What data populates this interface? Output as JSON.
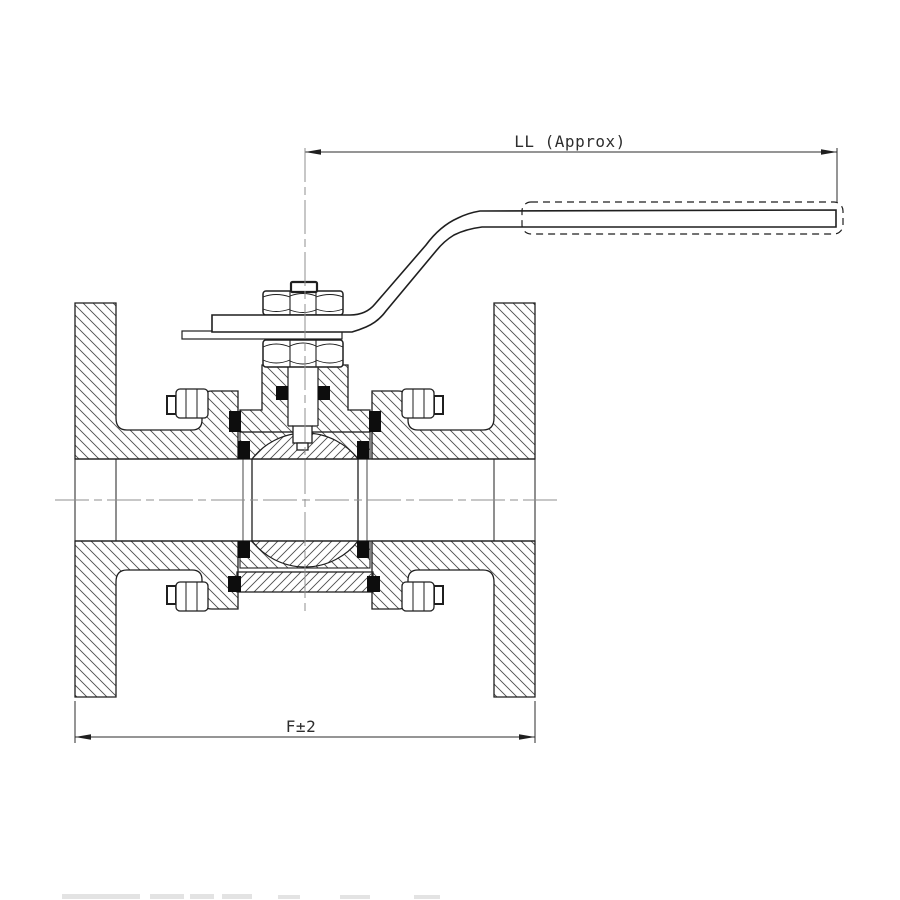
{
  "title": "Flanged ball valve sectional drawing",
  "dimensions": {
    "ll_label": "LL (Approx)",
    "f_label": "F±2"
  },
  "colors": {
    "background": "#ffffff",
    "line": "#1f1f1f",
    "hatch": "#4d4d4d",
    "centerline": "#8f8f8f",
    "seal_fill": "#0d0d0d",
    "dim_text": "#2e2e2e"
  },
  "components": [
    "left-flange",
    "right-flange",
    "body-hub",
    "center-body",
    "bonnet",
    "gland-nut",
    "stem-nut",
    "stem-cap",
    "stem",
    "packing-seals",
    "seat-rings",
    "ball",
    "lever-handle",
    "handle-grip-sleeve",
    "handle-stop-plate",
    "body-bolts",
    "bottom-retainer-plate",
    "flow-centerline",
    "stem-centerline"
  ]
}
